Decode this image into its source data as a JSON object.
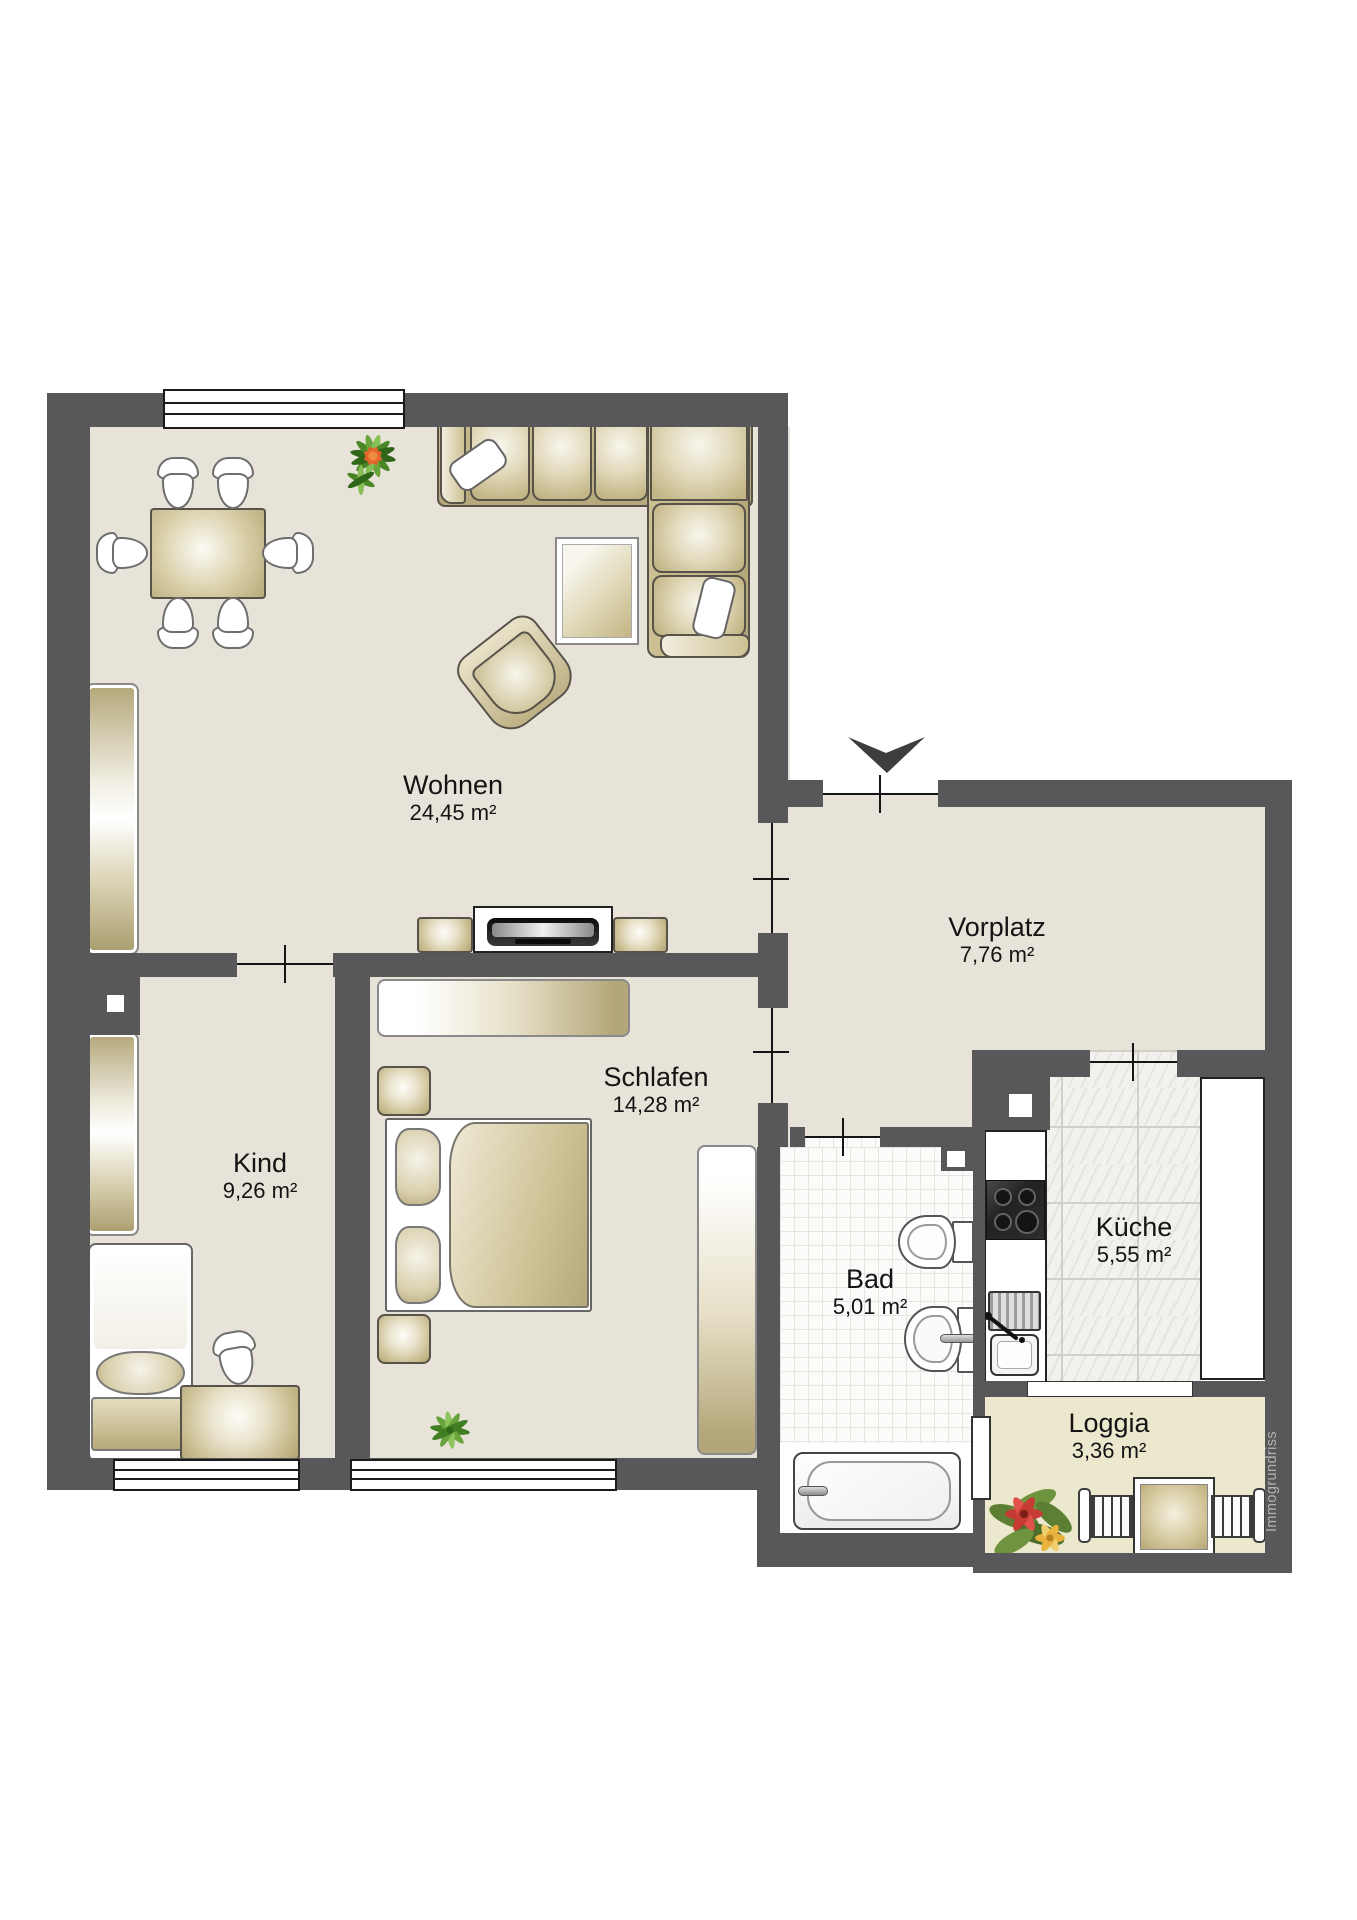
{
  "rooms": {
    "wohnen": {
      "name": "Wohnen",
      "area": "24,45 m²"
    },
    "vorplatz": {
      "name": "Vorplatz",
      "area": "7,76 m²"
    },
    "schlafen": {
      "name": "Schlafen",
      "area": "14,28 m²"
    },
    "kind": {
      "name": "Kind",
      "area": "9,26 m²"
    },
    "bad": {
      "name": "Bad",
      "area": "5,01 m²"
    },
    "kueche": {
      "name": "Küche",
      "area": "5,55 m²"
    },
    "loggia": {
      "name": "Loggia",
      "area": "3,36 m²"
    }
  },
  "watermark": "Immogrundriss",
  "colors": {
    "wall": "#58585a",
    "floor": "#e7e3d8",
    "loggia-floor": "#ebe8ce",
    "bad-floor": "#fbfbfa",
    "kueche-floor": "#f3f1ed",
    "plant-green": "#5d9434",
    "flower-red": "#c63b33",
    "flower-orange": "#d95f28"
  },
  "icons": {
    "entrance-arrow": "▼",
    "plant": "✳",
    "poinsettia": "❀"
  },
  "furniture": [
    "dining-table",
    "dining-chair",
    "corner-sofa",
    "coffee-table",
    "armchair",
    "tv-sideboard",
    "tv",
    "sideboard",
    "single-bed",
    "desk",
    "desk-chair",
    "double-bed",
    "nightstand",
    "dresser",
    "wardrobe",
    "toilet",
    "washbasin",
    "bathtub",
    "stove",
    "kitchen-sink",
    "kitchen-counter",
    "loggia-table",
    "loggia-chair"
  ]
}
